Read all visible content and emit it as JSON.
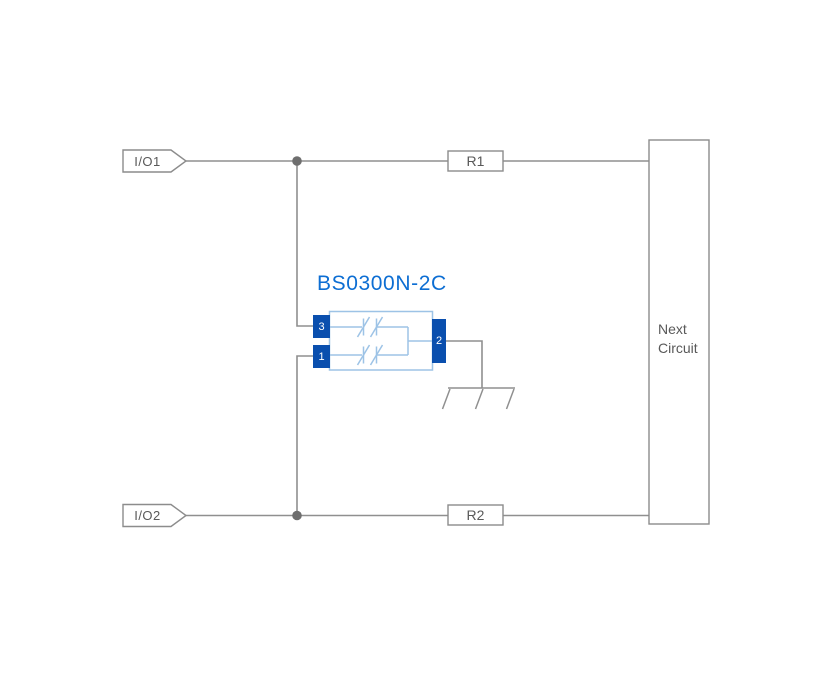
{
  "diagram": {
    "title": "BS0300N-2C",
    "ports": {
      "io1": "I/O1",
      "io2": "I/O2"
    },
    "resistors": {
      "r1": "R1",
      "r2": "R2"
    },
    "next_circuit": {
      "line1": "Next",
      "line2": "Circuit"
    },
    "component": {
      "name": "BS0300N-2C",
      "pins": {
        "pin3": "3",
        "pin1": "1",
        "pin2": "2"
      }
    },
    "icons": [
      "junction-dot-icon",
      "ground-icon",
      "bidirectional-diode-icon"
    ],
    "colors": {
      "accent_blue": "#0d6ed3",
      "pin_blue": "#0a4fae",
      "component_light_blue": "#9dc3e6",
      "wire_gray": "#8f8f8f",
      "outline_gray": "#8c8c8c",
      "junction_gray": "#6e6e6e",
      "text_gray": "#595959",
      "background": "#ffffff"
    }
  }
}
